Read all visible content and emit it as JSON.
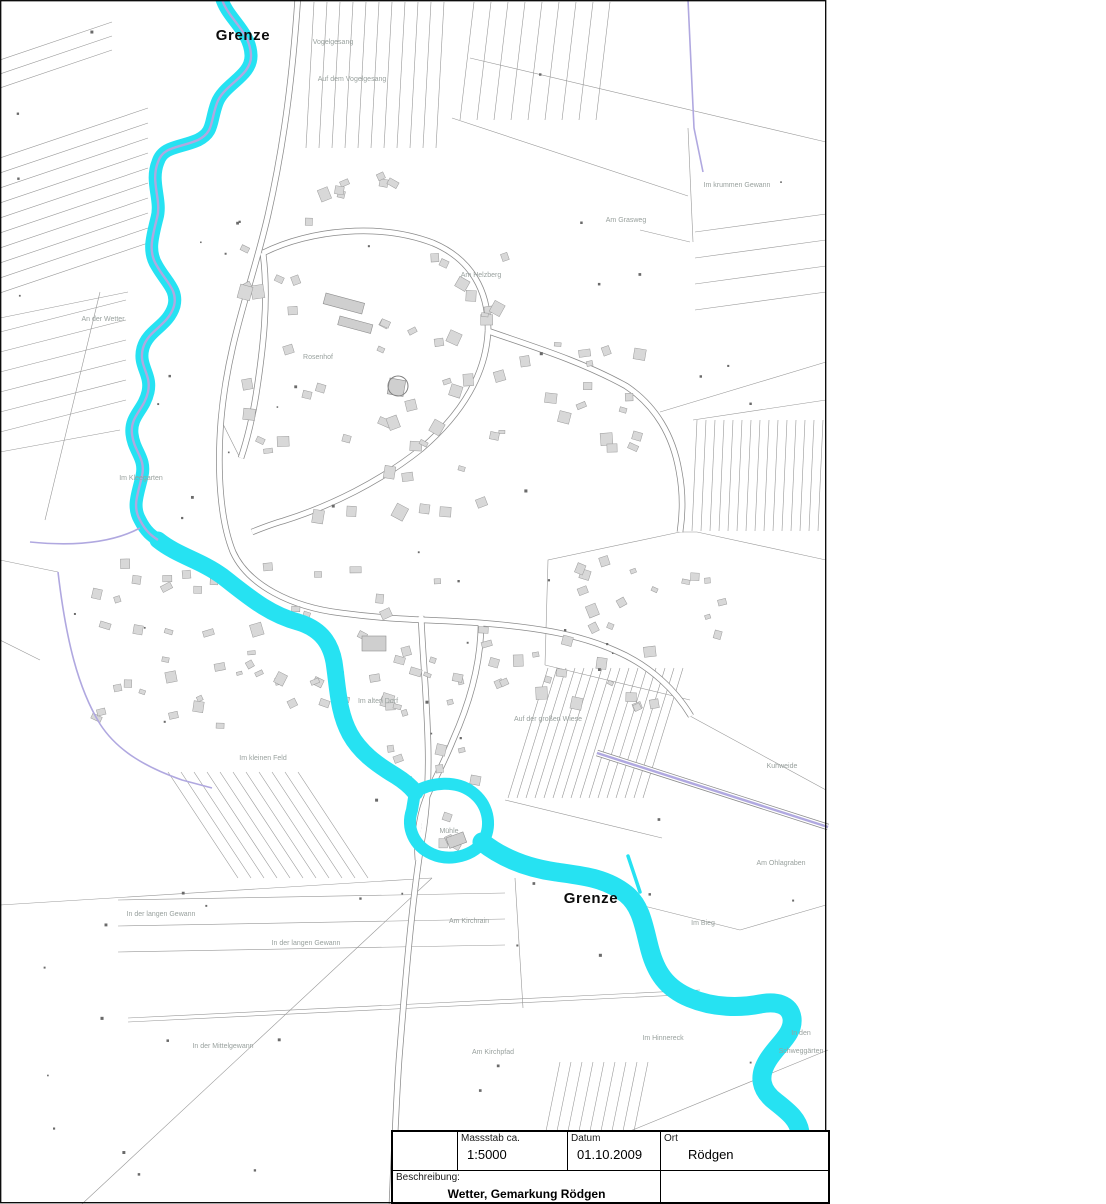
{
  "map": {
    "grenze_labels": [
      {
        "text": "Grenze"
      },
      {
        "text": "Grenze"
      }
    ],
    "field_labels": [
      {
        "text": "Vogelgesang"
      },
      {
        "text": "Auf dem Vogelgesang"
      },
      {
        "text": "Im krummen Gewann"
      },
      {
        "text": "Am Grasweg"
      },
      {
        "text": "Am Helzberg"
      },
      {
        "text": "An der Wetter"
      },
      {
        "text": "Rosenhof"
      },
      {
        "text": "Im Kleegarten"
      },
      {
        "text": "Im alten Dorf"
      },
      {
        "text": "Auf der großen Wiese"
      },
      {
        "text": "Im kleinen Feld"
      },
      {
        "text": "Kuhweide"
      },
      {
        "text": "Am Ohlagraben"
      },
      {
        "text": "Im Bieg"
      },
      {
        "text": "Am Kirchrain"
      },
      {
        "text": "In der langen Gewann"
      },
      {
        "text": "In der langen Gewann"
      },
      {
        "text": "In der Mittelgewann"
      },
      {
        "text": "Am Kirchpfad"
      },
      {
        "text": "Im Hinnereck"
      },
      {
        "text": "In den"
      },
      {
        "text": "Schweggärten"
      },
      {
        "text": "Mühle"
      }
    ]
  },
  "title_block": {
    "massstab_label": "Massstab ca.",
    "massstab_value": "1:5000",
    "datum_label": "Datum",
    "datum_value": "01.10.2009",
    "ort_label": "Ort",
    "ort_value": "Rödgen",
    "beschreibung_label": "Beschreibung:",
    "beschreibung_value": "Wetter, Gemarkung Rödgen"
  },
  "colors": {
    "river": "#26e2f2",
    "boundary": "#b0a8e0",
    "parcel_line": "#989898",
    "building_fill": "#d8d8d8",
    "building_stroke": "#9b9b9b",
    "field_label": "#99a19e",
    "grenze_label": "#0c0c0c"
  }
}
